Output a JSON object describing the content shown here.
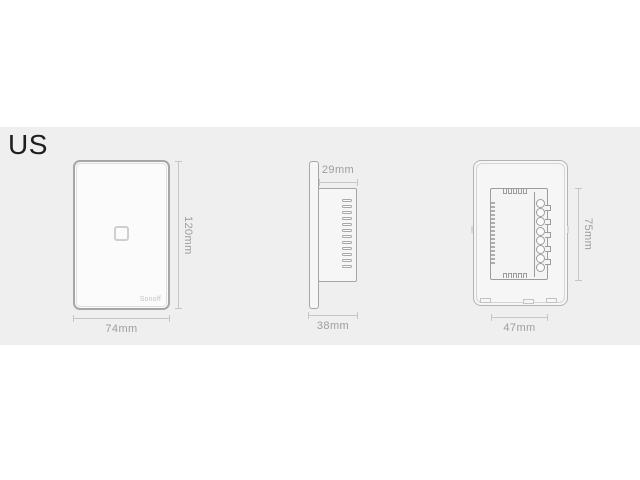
{
  "header": {
    "region_label": "US"
  },
  "diagram": {
    "front_view": {
      "brand_label": "Sonoff",
      "height_label": "120mm",
      "width_label": "74mm",
      "touch_button_count": 1
    },
    "side_view": {
      "body_depth_label": "29mm",
      "total_depth_label": "38mm",
      "vent_slot_count": 12
    },
    "back_view": {
      "module_height_label": "75mm",
      "module_width_label": "47mm",
      "terminal_count": 8,
      "left_tooth_count": 16,
      "top_tooth_count": 5,
      "bottom_tooth_count": 5,
      "right_notch_count": 5
    }
  },
  "colors": {
    "page_bg": "#ffffff",
    "band_bg": "#efefef",
    "outline": "#a6a6a6",
    "dim_line": "#c6c6c6",
    "dim_text": "#9e9e9e",
    "label_text": "#1e1e1e"
  }
}
